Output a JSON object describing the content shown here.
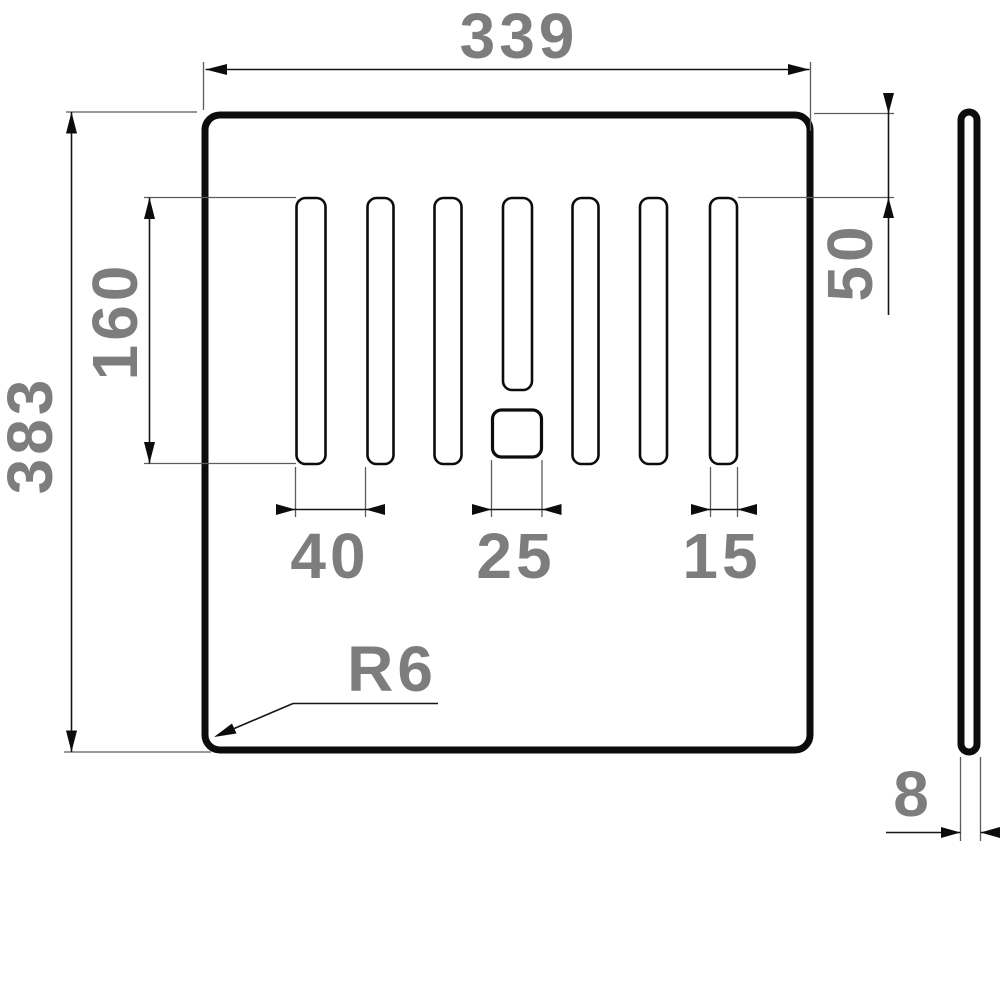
{
  "drawing": {
    "labels": {
      "overall_width": "339",
      "overall_height": "383",
      "slot_length": "160",
      "slot_top_offset": "50",
      "slot_pitch": "40",
      "square_hole_width": "25",
      "slot_width": "15",
      "corner_radius": "R6",
      "thickness": "8"
    },
    "colors": {
      "label": "#7d7d7d",
      "line": "#0c0c0c",
      "extension_line": "#5c5c5c",
      "background": "#ffffff"
    }
  }
}
